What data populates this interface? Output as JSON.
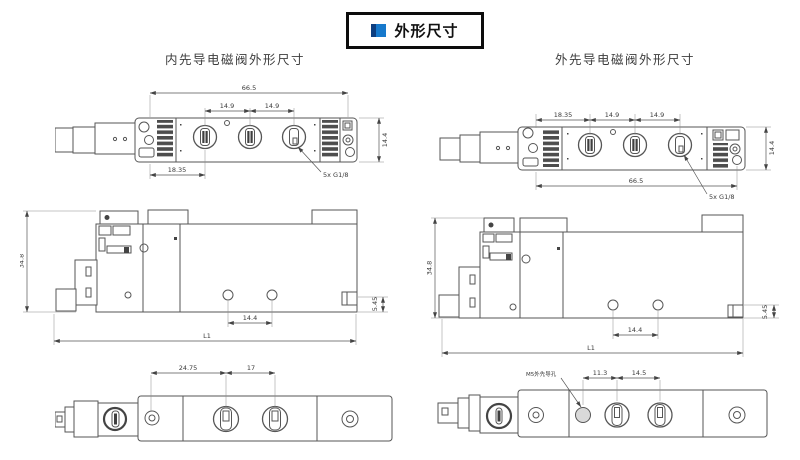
{
  "title_box": {
    "label": "外形尺寸"
  },
  "columns": {
    "left_heading": "内先导电磁阀外形尺寸",
    "right_heading": "外先导电磁阀外形尺寸"
  },
  "colors": {
    "icon_dark_blue": "#0d3e80",
    "icon_light_blue": "#1779cc",
    "line_gray": "#565656"
  },
  "internal_pilot": {
    "top_view": {
      "total_width": "66.5",
      "port_pitch_1": "14.9",
      "port_pitch_2": "14.9",
      "left_offset": "18.35",
      "depth": "14.4",
      "ports_note": "5x G1/8"
    },
    "side_view": {
      "height": "34.8",
      "length": "L1",
      "mount_hole_pitch": "14.4",
      "base_step": "5.45"
    },
    "bottom_view": {
      "dim_left": "24.75",
      "dim_mid": "17"
    }
  },
  "external_pilot": {
    "top_view": {
      "left_offset": "18.35",
      "port_pitch_1": "14.9",
      "port_pitch_2": "14.9",
      "total_width": "66.5",
      "depth": "14.4",
      "ports_note": "5x G1/8"
    },
    "side_view": {
      "height": "34.8",
      "length": "L1",
      "mount_hole_pitch": "14.4",
      "base_step": "5.45"
    },
    "bottom_view": {
      "pilot_hole_note": "M5外先导孔",
      "dim_1": "11.3",
      "dim_2": "14.5"
    }
  }
}
